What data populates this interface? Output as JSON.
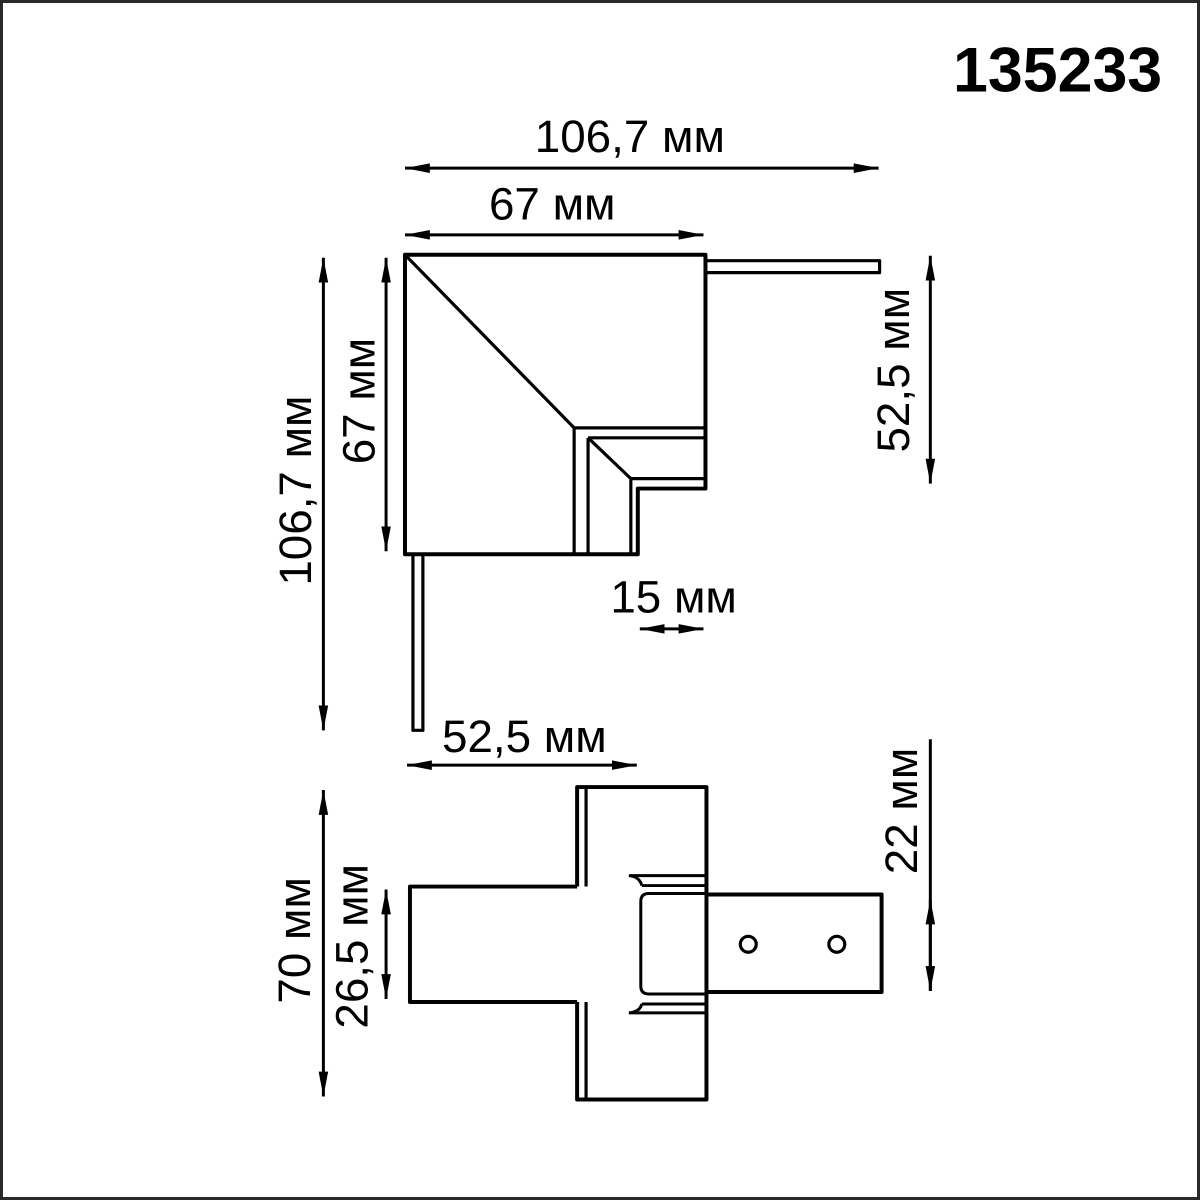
{
  "article_number": "135233",
  "unit": "мм",
  "colors": {
    "line": "#000000",
    "text": "#000000",
    "background": "#ffffff",
    "frame": "#2a2a2a"
  },
  "top_view": {
    "title": "corner connector top view",
    "dims": {
      "total_width": "106,7 мм",
      "body_width": "67 мм",
      "total_height": "106,7 мм",
      "body_height": "67 мм",
      "right_connector_depth": "52,5 мм",
      "step_width": "15 мм",
      "bottom_connector_depth": "52,5 мм"
    }
  },
  "bottom_view": {
    "title": "corner connector side view",
    "dims": {
      "body_height": "70 мм",
      "track_height": "26,5 мм",
      "busbar_height": "22 мм"
    }
  }
}
